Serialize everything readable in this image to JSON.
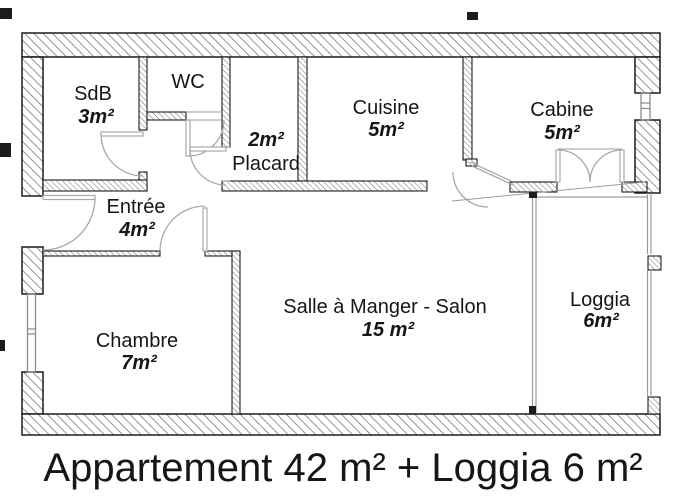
{
  "caption": "Appartement 42 m² + Loggia 6 m²",
  "colors": {
    "background": "#ffffff",
    "wall_outline": "#1c1c1c",
    "wall_hatch": "#6a6a6a",
    "door_swing": "#a9a9a9",
    "window_frame": "#8c8c8c",
    "text": "#161616"
  },
  "rooms": [
    {
      "id": "sdb",
      "name": "SdB",
      "area": "3m²"
    },
    {
      "id": "wc",
      "name": "WC",
      "area": ""
    },
    {
      "id": "placard",
      "name": "Placard",
      "area": "2m²"
    },
    {
      "id": "cuisine",
      "name": "Cuisine",
      "area": "5m²"
    },
    {
      "id": "cabine",
      "name": "Cabine",
      "area": "5m²"
    },
    {
      "id": "entree",
      "name": "Entrée",
      "area": "4m²"
    },
    {
      "id": "chambre",
      "name": "Chambre",
      "area": "7m²"
    },
    {
      "id": "salon",
      "name": "Salle à Manger - Salon",
      "area": "15 m²"
    },
    {
      "id": "loggia",
      "name": "Loggia",
      "area": "6m²"
    }
  ]
}
